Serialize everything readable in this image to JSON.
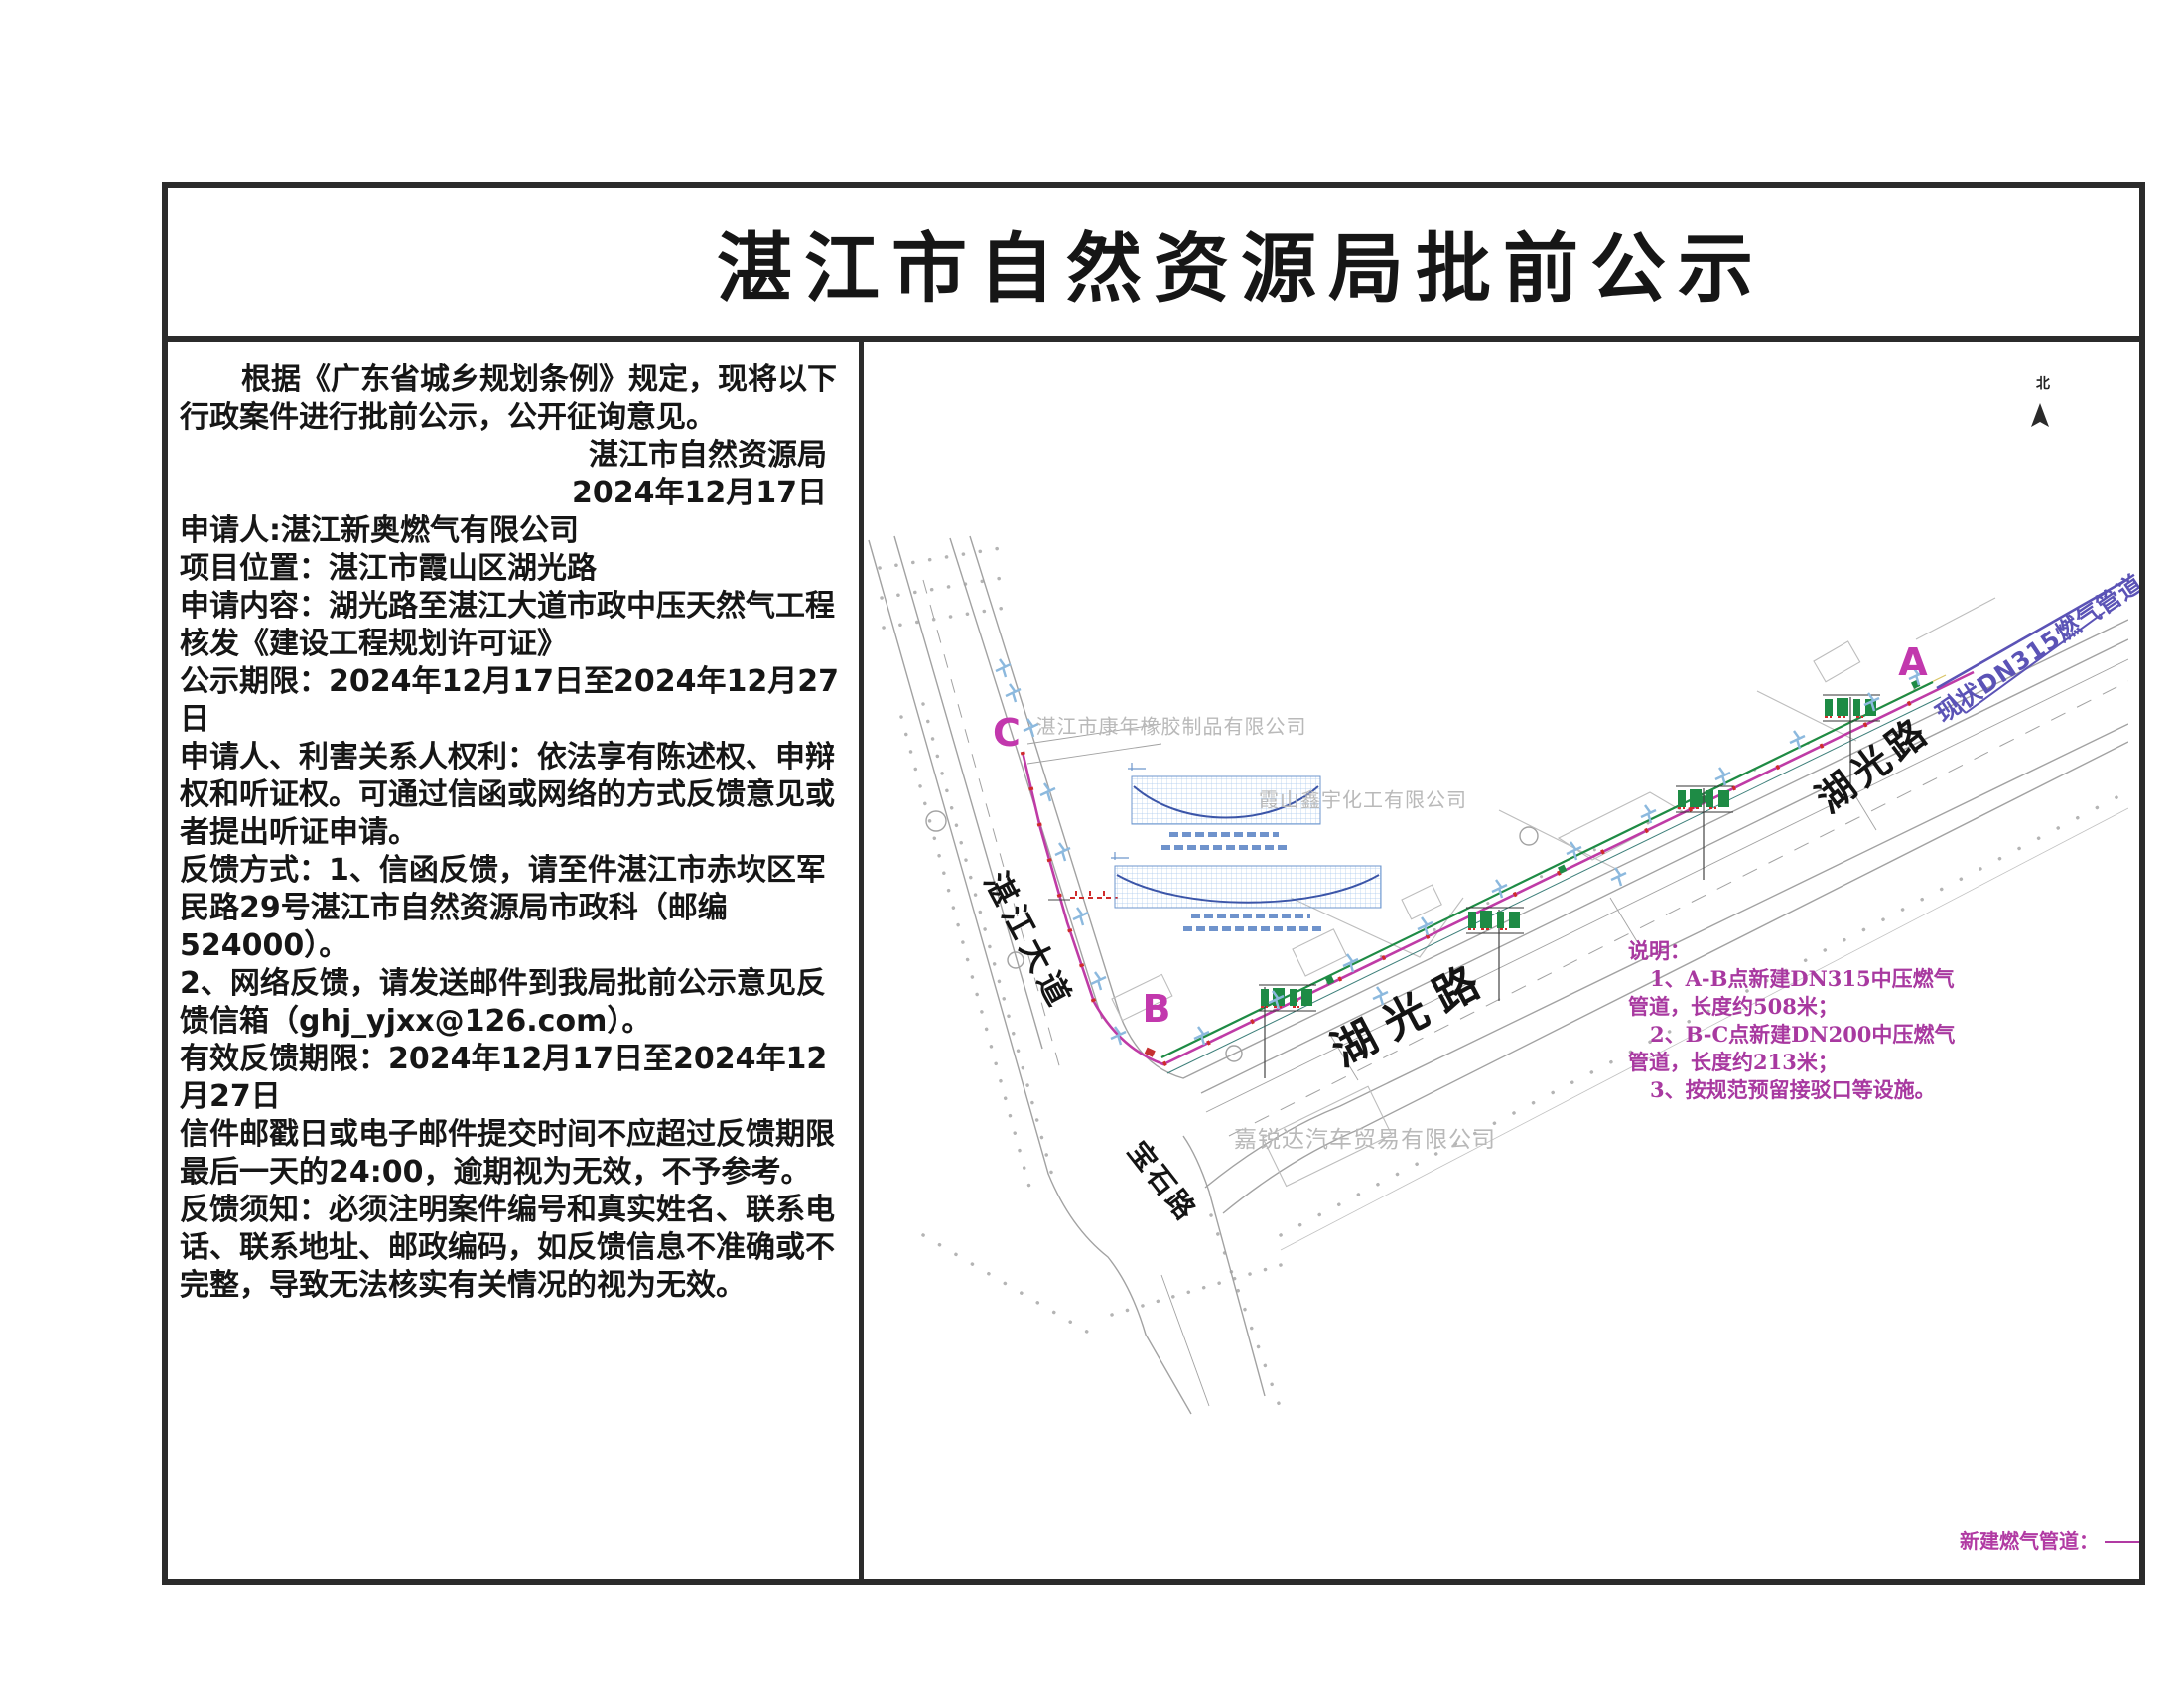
{
  "title": "湛江市自然资源局批前公示",
  "notice": {
    "intro": "根据《广东省城乡规划条例》规定，现将以下行政案件进行批前公示，公开征询意见。",
    "agency": "湛江市自然资源局",
    "date": "2024年12月17日",
    "applicant": "申请人:湛江新奥燃气有限公司",
    "location": "项目位置：湛江市霞山区湖光路",
    "content": "申请内容：湖光路至湛江大道市政中压天然气工程",
    "content2": "核发《建设工程规划许可证》",
    "period": "公示期限：2024年12月17日至2024年12月27日",
    "rights": "申请人、利害关系人权利：依法享有陈述权、申辩权和听证权。可通过信函或网络的方式反馈意见或者提出听证申请。",
    "feedback_mail": "反馈方式：1、信函反馈，请至件湛江市赤坎区军民路29号湛江市自然资源局市政科（邮编524000）。",
    "feedback_online": "2、网络反馈，请发送邮件到我局批前公示意见反馈信箱（ghj_yjxx@126.com）。",
    "valid_period": "有效反馈期限：2024年12月17日至2024年12月27日",
    "deadline_note": "信件邮戳日或电子邮件提交时间不应超过反馈期限最后一天的24:00，逾期视为无效，不予参考。",
    "requirement": "反馈须知：必须注明案件编号和真实姓名、联系电话、联系地址、邮政编码，如反馈信息不准确或不完整，导致无法核实有关情况的视为无效。"
  },
  "map": {
    "north_label": "北",
    "points": {
      "a": "A",
      "b": "B",
      "c": "C"
    },
    "roads": {
      "zhanjiang_avenue": "湛江大道",
      "huguang_road": "湖光路",
      "baoshi_road": "宝石路"
    },
    "companies": {
      "kangnian": "湛江市康年橡胶制品有限公司",
      "xinyu": "霞山鑫宇化工有限公司",
      "jiaruida": "嘉锐达汽车贸易有限公司"
    },
    "existing_pipeline_label": "现状DN315燃气管道",
    "notes": {
      "title": "说明：",
      "line1": "1、A-B点新建DN315中压燃气",
      "line2": "管道，长度约508米；",
      "line3": "2、B-C点新建DN200中压燃气",
      "line4": "管道，长度约213米；",
      "line5": "3、按规范预留接驳口等设施。"
    },
    "legend": {
      "new_pipeline_label": "新建燃气管道："
    }
  },
  "colors": {
    "label_magenta": "#c238ad",
    "notes_magenta": "#a839a0",
    "new_pipeline_magenta": "#bf3ba6",
    "existing_pipeline_purple": "#5b53b6",
    "pipeline_green": "#1e8b45",
    "road_gray": "#a2a2a2"
  }
}
